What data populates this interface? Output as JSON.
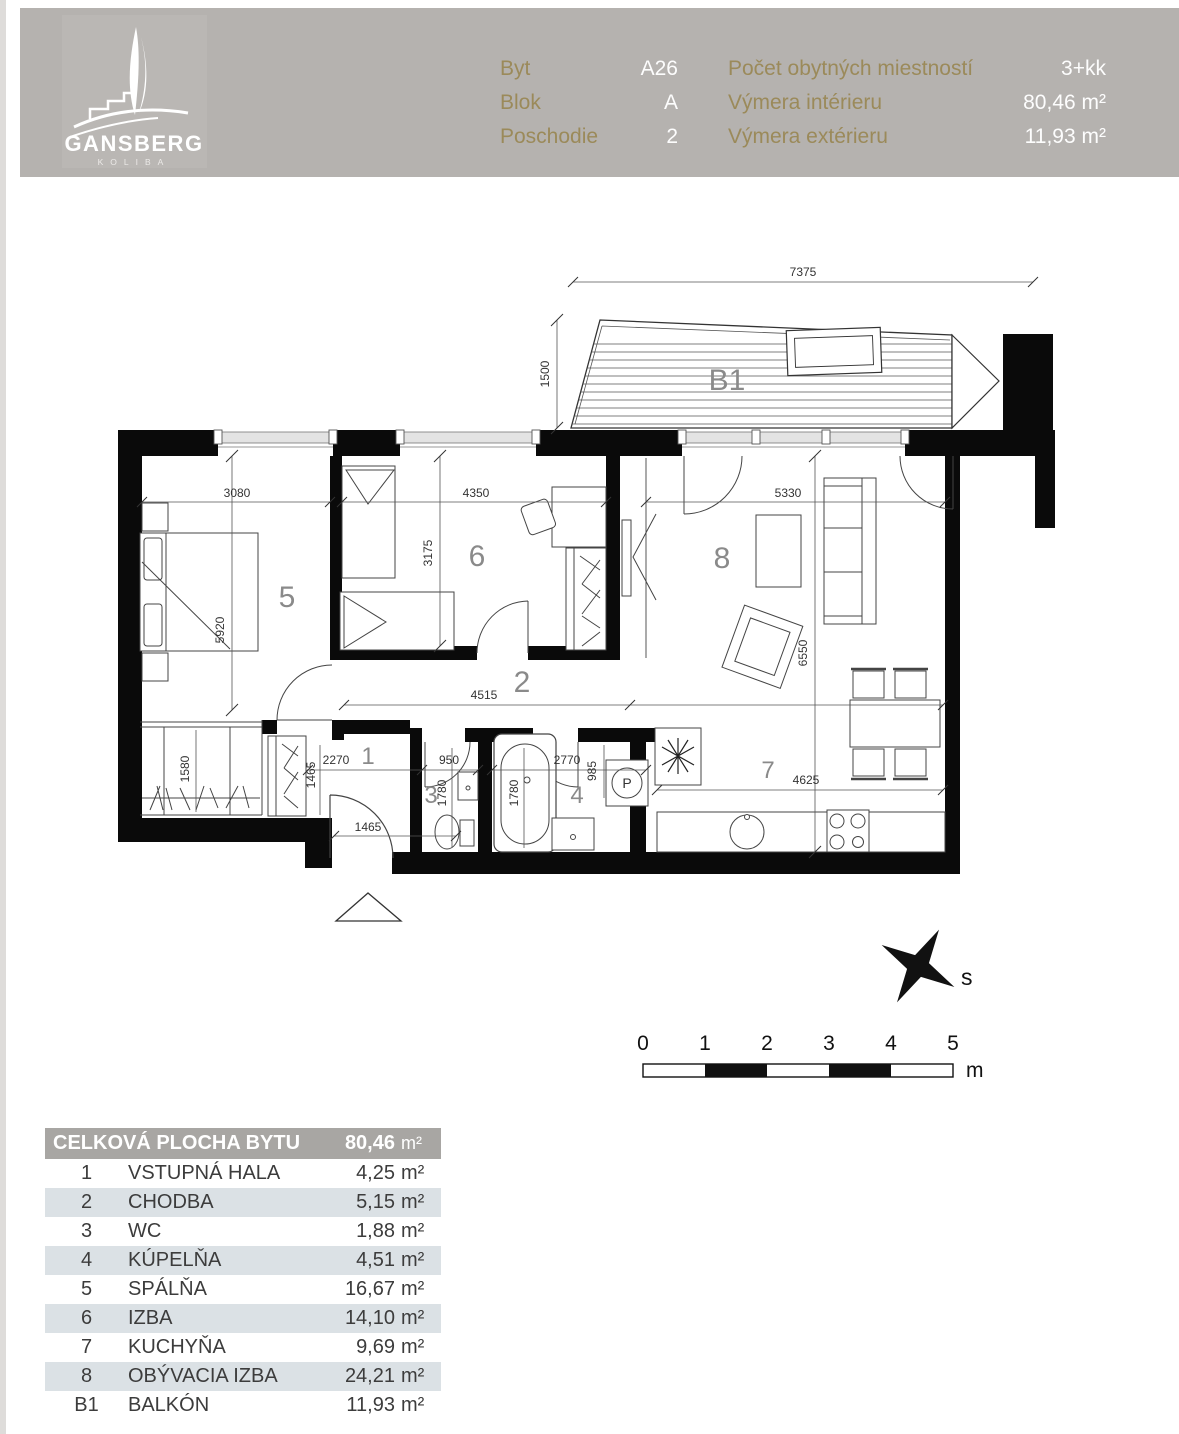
{
  "header": {
    "brand": {
      "name": "GANSBERG",
      "sub": "KOLIBA"
    },
    "fields_left": [
      {
        "label": "Byt",
        "value": "A26"
      },
      {
        "label": "Blok",
        "value": "A"
      },
      {
        "label": "Poschodie",
        "value": "2"
      }
    ],
    "fields_right": [
      {
        "label": "Počet obytných miestností",
        "value": "3+kk"
      },
      {
        "label": "Výmera intérieru",
        "value": "80,46 m²"
      },
      {
        "label": "Výmera extérieru",
        "value": "11,93 m²"
      }
    ]
  },
  "plan": {
    "balcony_label": "B1",
    "compass_label": "s",
    "washer_label": "P",
    "rooms": {
      "n1": "1",
      "n2": "2",
      "n3": "3",
      "n4": "4",
      "n5": "5",
      "n6": "6",
      "n7": "7",
      "n8": "8"
    },
    "dims": {
      "top_width": "7375",
      "balcony_depth": "1500",
      "r5_width": "3080",
      "r6_width": "4350",
      "r8_width": "5330",
      "r5_height": "5920",
      "r6_height": "3175",
      "r8_height": "6550",
      "corridor": "4515",
      "hall": "2270",
      "hall_depth": "1465",
      "hall_bottom": "1465",
      "wc_width": "950",
      "wc_depth": "1780",
      "bath_width": "2770",
      "bath_side": "985",
      "bath_depth": "1780",
      "kitchen": "4625",
      "closet": "1580"
    },
    "scale": {
      "ticks": [
        "0",
        "1",
        "2",
        "3",
        "4",
        "5"
      ],
      "unit": "m"
    }
  },
  "table": {
    "header": {
      "label": "CELKOVÁ PLOCHA BYTU",
      "value": "80,46",
      "unit": "m²"
    },
    "rows": [
      {
        "num": "1",
        "name": "VSTUPNÁ HALA",
        "value": "4,25",
        "unit": "m²"
      },
      {
        "num": "2",
        "name": "CHODBA",
        "value": "5,15",
        "unit": "m²"
      },
      {
        "num": "3",
        "name": "WC",
        "value": "1,88",
        "unit": "m²"
      },
      {
        "num": "4",
        "name": "KÚPELŇA",
        "value": "4,51",
        "unit": "m²"
      },
      {
        "num": "5",
        "name": "SPÁLŇA",
        "value": "16,67",
        "unit": "m²"
      },
      {
        "num": "6",
        "name": "IZBA",
        "value": "14,10",
        "unit": "m²"
      },
      {
        "num": "7",
        "name": "KUCHYŇA",
        "value": "9,69",
        "unit": "m²"
      },
      {
        "num": "8",
        "name": "OBÝVACIA IZBA",
        "value": "24,21",
        "unit": "m²"
      },
      {
        "num": "B1",
        "name": "BALKÓN",
        "value": "11,93",
        "unit": "m²"
      }
    ]
  }
}
